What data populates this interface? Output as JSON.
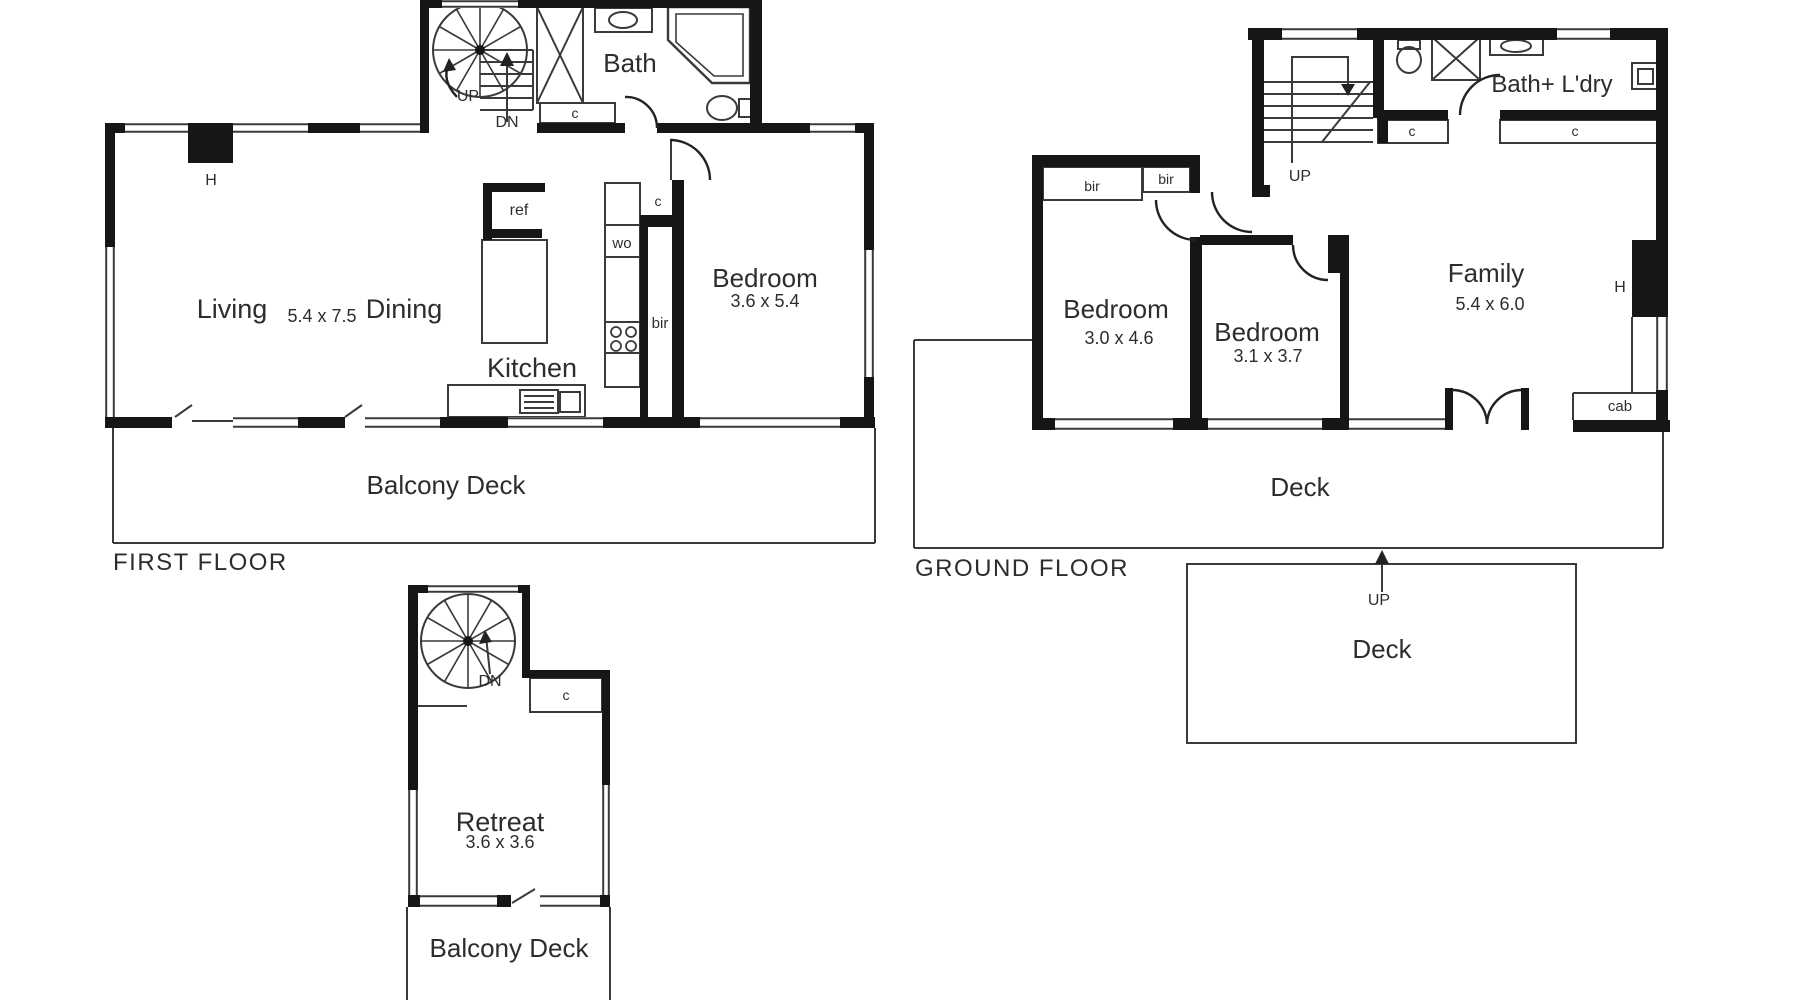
{
  "document_type": "residential floor plan",
  "colors": {
    "background": "#ffffff",
    "wall": "#161616",
    "line": "#3a3a3a",
    "text": "#2d2d2d"
  },
  "sections": [
    {
      "name": "first-floor",
      "title": "FIRST FLOOR",
      "labels": [
        {
          "name": "ff-stairs-up-label",
          "text": "UP",
          "x": 468,
          "y": 101,
          "size": 16
        },
        {
          "name": "ff-stairs-dn-label",
          "text": "DN",
          "x": 507,
          "y": 127,
          "size": 16
        },
        {
          "name": "ff-bath-label",
          "text": "Bath",
          "x": 630,
          "y": 72,
          "size": 26
        },
        {
          "name": "ff-hall-cupboard-label",
          "text": "c",
          "x": 575,
          "y": 118,
          "size": 14
        },
        {
          "name": "ff-heater-label",
          "text": "H",
          "x": 211,
          "y": 185,
          "size": 16
        },
        {
          "name": "ff-fridge-label",
          "text": "ref",
          "x": 519,
          "y": 215,
          "size": 16
        },
        {
          "name": "ff-living-label",
          "text": "Living",
          "x": 232,
          "y": 318,
          "size": 27
        },
        {
          "name": "ff-living-dining-dimensions",
          "text": "5.4 x 7.5",
          "x": 322,
          "y": 322,
          "size": 18
        },
        {
          "name": "ff-dining-label",
          "text": "Dining",
          "x": 404,
          "y": 318,
          "size": 27
        },
        {
          "name": "ff-wall-oven-label",
          "text": "wo",
          "x": 622,
          "y": 248,
          "size": 15
        },
        {
          "name": "ff-kitchen-cupboard-label",
          "text": "c",
          "x": 658,
          "y": 206,
          "size": 14
        },
        {
          "name": "ff-built-in-robe-label",
          "text": "bir",
          "x": 660,
          "y": 328,
          "size": 15
        },
        {
          "name": "ff-bedroom-label",
          "text": "Bedroom",
          "x": 765,
          "y": 287,
          "size": 26
        },
        {
          "name": "ff-bedroom-dimensions",
          "text": "3.6 x 5.4",
          "x": 765,
          "y": 307,
          "size": 18
        },
        {
          "name": "ff-kitchen-label",
          "text": "Kitchen",
          "x": 532,
          "y": 377,
          "size": 27
        },
        {
          "name": "ff-balcony-deck-label",
          "text": "Balcony Deck",
          "x": 446,
          "y": 494,
          "size": 26
        },
        {
          "name": "first-floor-title",
          "text": "FIRST FLOOR",
          "x": 113,
          "y": 570,
          "size": 24,
          "anchor": "start",
          "ls": 1.5
        }
      ]
    },
    {
      "name": "ground-floor",
      "title": "GROUND FLOOR",
      "labels": [
        {
          "name": "gf-bedroom1-robe-left-label",
          "text": "bir",
          "x": 1092,
          "y": 191,
          "size": 14
        },
        {
          "name": "gf-bedroom1-robe-right-label",
          "text": "bir",
          "x": 1166,
          "y": 184,
          "size": 14
        },
        {
          "name": "gf-stairs-up-label",
          "text": "UP",
          "x": 1300,
          "y": 181,
          "size": 16
        },
        {
          "name": "gf-bath-laundry-label",
          "text": "Bath+ L'dry",
          "x": 1552,
          "y": 92,
          "size": 24
        },
        {
          "name": "gf-cupboard-left-label",
          "text": "c",
          "x": 1412,
          "y": 136,
          "size": 14
        },
        {
          "name": "gf-cupboard-right-label",
          "text": "c",
          "x": 1575,
          "y": 136,
          "size": 14
        },
        {
          "name": "gf-bedroom1-label",
          "text": "Bedroom",
          "x": 1116,
          "y": 318,
          "size": 26
        },
        {
          "name": "gf-bedroom1-dimensions",
          "text": "3.0 x 4.6",
          "x": 1119,
          "y": 344,
          "size": 18
        },
        {
          "name": "gf-bedroom2-label",
          "text": "Bedroom",
          "x": 1267,
          "y": 341,
          "size": 26
        },
        {
          "name": "gf-bedroom2-dimensions",
          "text": "3.1 x 3.7",
          "x": 1268,
          "y": 362,
          "size": 18
        },
        {
          "name": "gf-family-label",
          "text": "Family",
          "x": 1486,
          "y": 282,
          "size": 26
        },
        {
          "name": "gf-family-dimensions",
          "text": "5.4 x 6.0",
          "x": 1490,
          "y": 310,
          "size": 18
        },
        {
          "name": "gf-heater-label",
          "text": "H",
          "x": 1620,
          "y": 292,
          "size": 16
        },
        {
          "name": "gf-cabinet-label",
          "text": "cab",
          "x": 1620,
          "y": 411,
          "size": 15
        },
        {
          "name": "gf-deck-label",
          "text": "Deck",
          "x": 1300,
          "y": 496,
          "size": 26
        },
        {
          "name": "ground-floor-title",
          "text": "GROUND FLOOR",
          "x": 915,
          "y": 576,
          "size": 24,
          "anchor": "start",
          "ls": 1.5
        },
        {
          "name": "gf-lower-deck-up-label",
          "text": "UP",
          "x": 1379,
          "y": 605,
          "size": 16
        },
        {
          "name": "gf-lower-deck-label",
          "text": "Deck",
          "x": 1382,
          "y": 658,
          "size": 26
        }
      ]
    },
    {
      "name": "retreat-level",
      "title": "",
      "labels": [
        {
          "name": "retreat-stairs-dn-label",
          "text": "DN",
          "x": 490,
          "y": 686,
          "size": 16
        },
        {
          "name": "retreat-cupboard-label",
          "text": "c",
          "x": 566,
          "y": 700,
          "size": 14
        },
        {
          "name": "retreat-label",
          "text": "Retreat",
          "x": 500,
          "y": 831,
          "size": 27
        },
        {
          "name": "retreat-dimensions",
          "text": "3.6 x 3.6",
          "x": 500,
          "y": 848,
          "size": 18
        },
        {
          "name": "retreat-balcony-deck-label",
          "text": "Balcony Deck",
          "x": 509,
          "y": 957,
          "size": 26
        }
      ]
    }
  ]
}
